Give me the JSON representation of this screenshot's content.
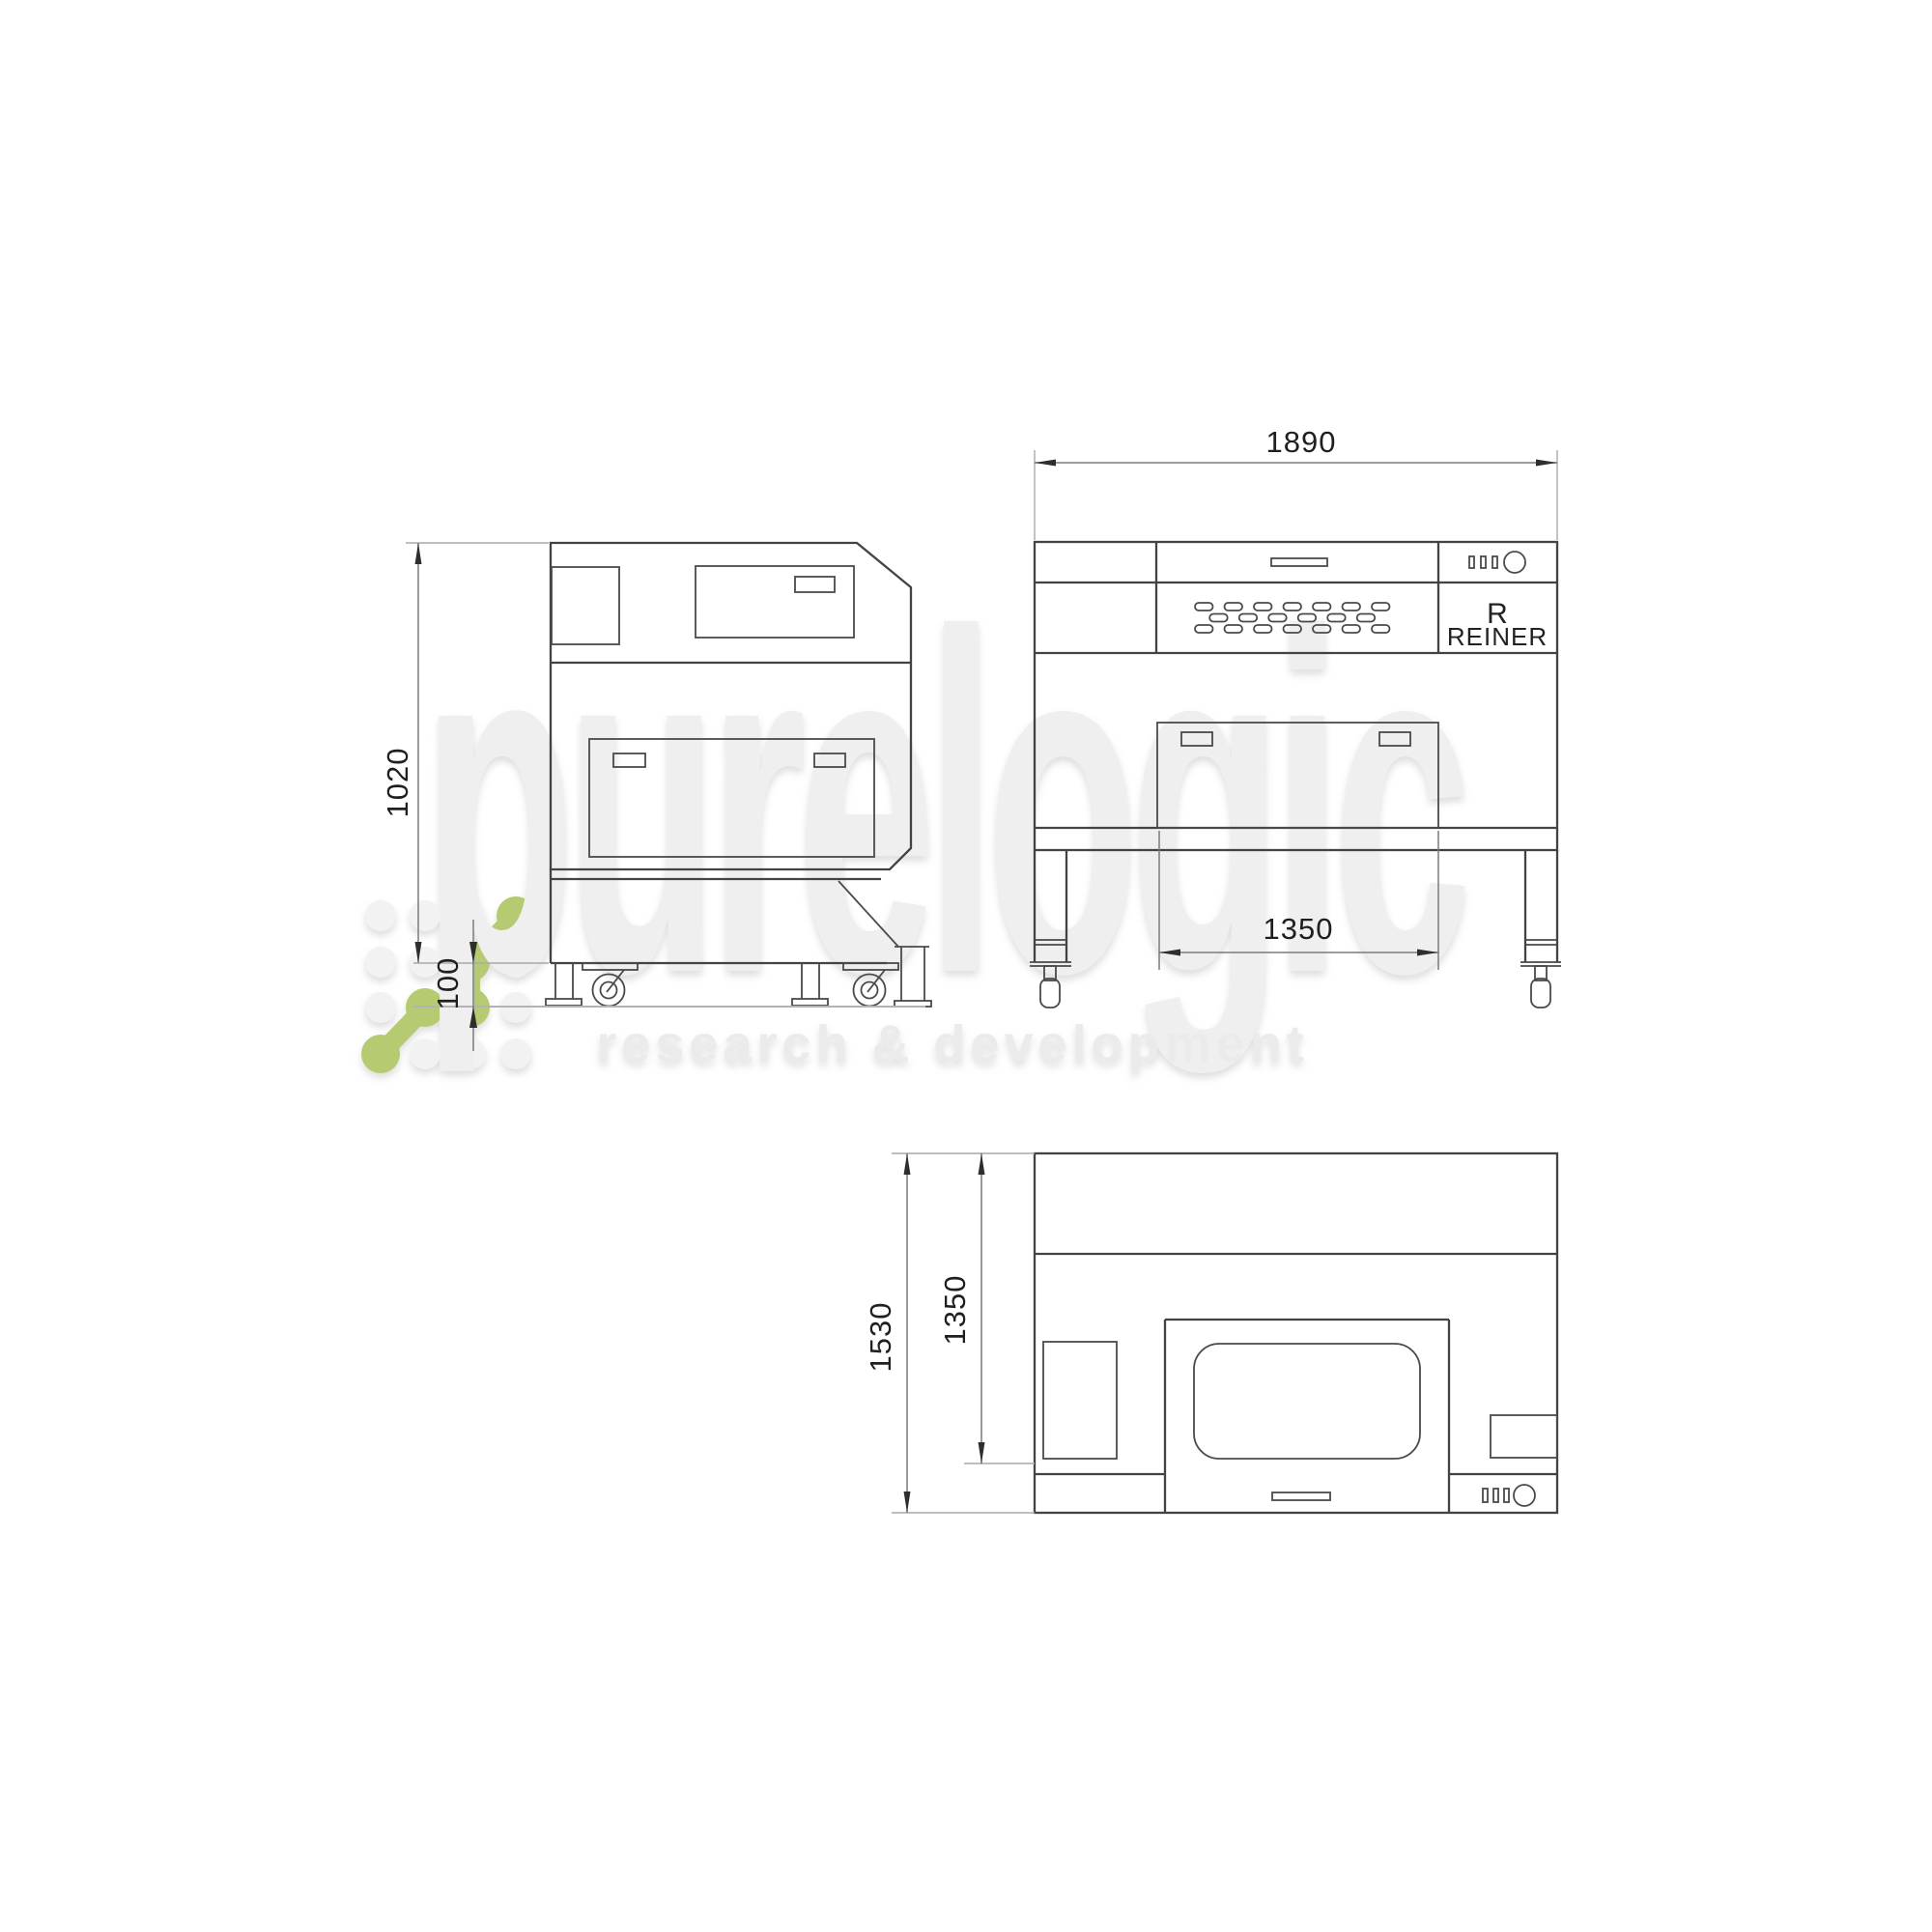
{
  "watermark": {
    "brand": "purelogic",
    "tagline": "research & development"
  },
  "machine_label": {
    "mark": "R",
    "name": "REINER"
  },
  "dimensions": {
    "front_width": "1890",
    "front_stand_width": "1350",
    "side_height": "1020",
    "ground_clearance": "100",
    "top_depth": "1530",
    "top_body_depth": "1350"
  },
  "colors": {
    "background": "#ffffff",
    "line": "#434343",
    "detail-line": "#4a4a4a",
    "dim-line": "#7b7b7b",
    "ext-line": "#a9a9a9",
    "floor-line": "#b3b3b3",
    "dim-text": "#1f1f1f",
    "label-text": "#222222",
    "wm-green": "#b6ca72",
    "wm-circle": "#f2f2f2",
    "wm-big-text": "#efefef",
    "wm-tagline-text": "#ebebeb"
  }
}
